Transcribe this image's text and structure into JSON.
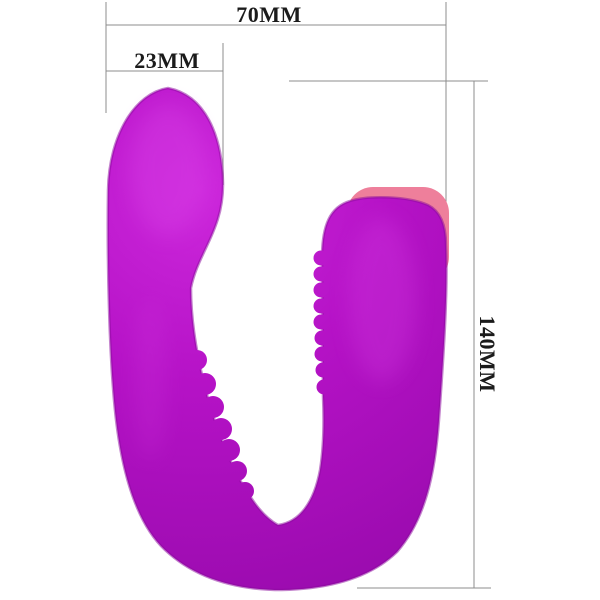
{
  "page": {
    "background": "#ffffff"
  },
  "product": {
    "description": "u-shaped-purple-silicone-massager",
    "body_color": "#b512c6",
    "body_color_light": "#cd28dc",
    "body_color_dark": "#9a0bae",
    "edge_shade_color": "#8a099c",
    "cap_color": "#ee7f9b"
  },
  "dimensions": {
    "line_color": "#8c8c8c",
    "text_color": "#1b1b1b",
    "width_label": "70MM",
    "head_width_label": "23MM",
    "length_label": "140MM"
  }
}
